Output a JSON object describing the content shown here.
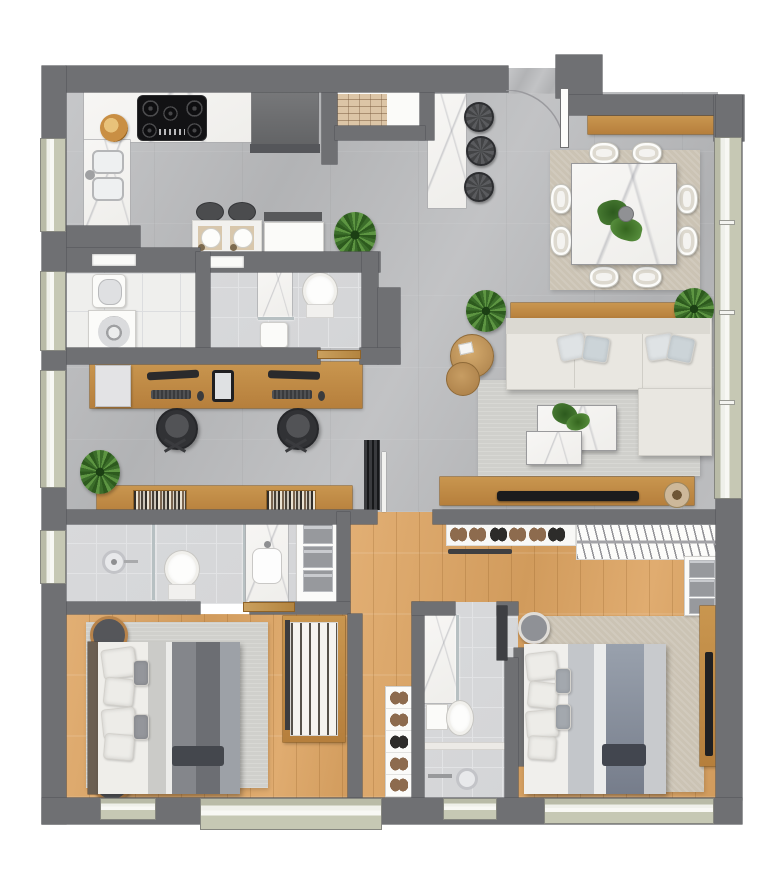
{
  "meta": {
    "type": "architectural-floor-plan",
    "view": "top-down 2D rendered plan",
    "text_labels_visible": "none",
    "canvas": {
      "width_px": 768,
      "height_px": 882,
      "background": "#ffffff"
    }
  },
  "palette": {
    "wall": "#6f7073",
    "wallEdge": "#55565a",
    "concA": "#c6c7c9",
    "concB": "#b2b3b5",
    "woodA": "#e2af74",
    "woodB": "#d19b5c",
    "furnA": "#c9964f",
    "furnB": "#b67f3c",
    "furnEdge": "#8f6226",
    "marbleA": "#f7f6f4",
    "marbleB": "#efeeeb",
    "sillA": "#b9bba7",
    "sillB": "#c6c8b4",
    "tileW": "#efefed",
    "tileB": "#d4d5d7",
    "sofaA": "#e9e7e1",
    "sofaB": "#dbd9d2",
    "rugBeige": "#cbc3b4",
    "rugGray": "#d0d0cc",
    "plantA": "#3b6d2a",
    "plantB": "#5d9542",
    "appl": "#121214",
    "steel": "#c3c4c8",
    "darkItem": "#3e3f43",
    "blanket1": "#84868b",
    "blanket2": "#6c6e73",
    "blanketM1": "#99a1ad",
    "blanketM2": "#767d8b"
  },
  "rooms": [
    {
      "name": "kitchen",
      "floor": "gray concrete with white marble counters",
      "items": [
        "L-shaped marble counter",
        "five-burner gas cooktop",
        "double basin sink with faucet",
        "wood fruit bowl",
        "refrigerator",
        "pantry shelf (brick texture)",
        "breakfast table with 2 dark stools and 2 place settings",
        "white service cabinet with dark bench",
        "potted plant"
      ]
    },
    {
      "name": "entry",
      "items": [
        "entry door with quarter-circle swing arc",
        "marble bar island",
        "3 round dark bar stools"
      ]
    },
    {
      "name": "dining-room",
      "floor": "gray concrete",
      "items": [
        "square marble dining table",
        "8 upholstered chairs",
        "monstera plant centerpiece with vase",
        "beige area rug",
        "wood sideboard"
      ]
    },
    {
      "name": "living-room",
      "floor": "gray concrete",
      "items": [
        "L-shaped cream sectional sofa",
        "4 throw pillows",
        "wood console behind sofa",
        "2 nesting round wood side tables",
        "2 overlapping marble coffee tables with plant",
        "gray area rug",
        "wood TV console",
        "flat TV",
        "round decor bowl",
        "2 potted plants"
      ]
    },
    {
      "name": "home-office",
      "floor": "gray concrete",
      "items": [
        "long wood desk",
        "printer",
        "2 monitors",
        "2 keyboards",
        "2 mice",
        "tablet",
        "2 dark office chairs",
        "wood bookshelf with 2 book groups",
        "potted plant",
        "dark slatted divider door"
      ]
    },
    {
      "name": "laundry",
      "floor": "white tile",
      "items": [
        "utility sink",
        "washing machine with round drum",
        "wall niche"
      ]
    },
    {
      "name": "powder-room",
      "floor": "gray tile",
      "items": [
        "marble shower stall with glass",
        "white sink box",
        "toilet",
        "wall niche",
        "wood door leaf"
      ]
    },
    {
      "name": "bathroom-1",
      "floor": "gray tile",
      "items": [
        "walk-in shower with round head and glass partition",
        "toilet",
        "marble vanity with rectangular sink",
        "linen cabinet with 3 gray towel stacks",
        "left-wall window"
      ]
    },
    {
      "name": "bedroom-1",
      "floor": "wood",
      "items": [
        "double bed with gray two-tone bedding",
        "headboard",
        "4 white pillows",
        "2 gray accent pillows",
        "dark folded runner",
        "area rug",
        "2 round dark poufs",
        "open wardrobe with hanging-clothes stripes",
        "wood door leaf"
      ]
    },
    {
      "name": "hallway",
      "floor": "wood",
      "items": [
        "white shoe rack with 5 shoe pairs"
      ]
    },
    {
      "name": "bathroom-2-central",
      "floor": "gray tile",
      "items": [
        "marble shower stall with glass",
        "toilet with tank",
        "marble threshold strip",
        "round steel floor drain",
        "towel bar",
        "dark door leaf"
      ]
    },
    {
      "name": "master-bedroom",
      "floor": "wood",
      "items": [
        "double bed with blue-gray bedding",
        "headboard",
        "4 white pillows",
        "2 gray accent pillows",
        "dark navy folded blanket",
        "beige area rug",
        "round gray pouf",
        "wood media panel with wall TV",
        "dresser with 3 folded-clothes stacks"
      ]
    },
    {
      "name": "master-closet",
      "floor": "wood",
      "items": [
        "shoe shelf with 6 pairs",
        "dark clothes rod",
        "hanging rack with hanger hatching"
      ]
    }
  ],
  "openings": {
    "windows_left_wall": 4,
    "windows_bottom_wall": 4,
    "right_wall": "full-height glazed sliding panel with mullion ticks",
    "entry": "top, door leaf with swing arc"
  },
  "counts": {
    "dining_chairs": 8,
    "bar_stools": 3,
    "office_chairs": 2,
    "beds": 2,
    "toilets": 3,
    "plants": 7,
    "shoe_pairs": 11
  }
}
